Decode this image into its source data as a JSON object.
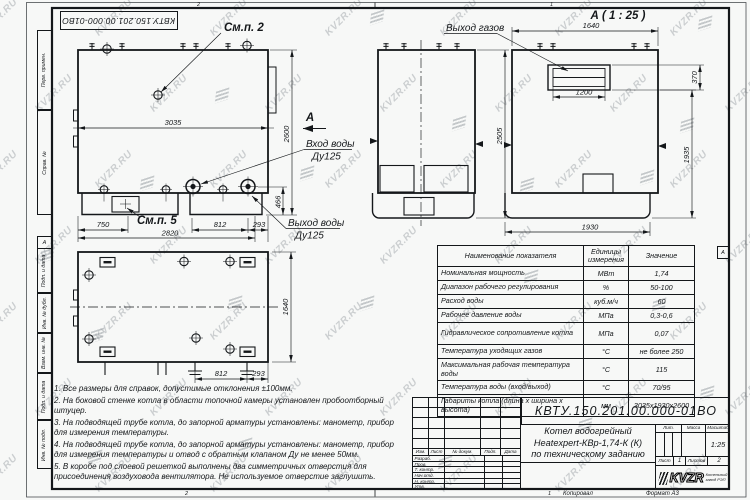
{
  "watermark": {
    "text": "KVZR.RU"
  },
  "sheet": {
    "doc_number": "КВТУ.150.201.00.000-01ВО",
    "zones": {
      "top_left": "2",
      "top_right": "1",
      "bottom_left": "2",
      "bottom_right": "1",
      "side_left": "А",
      "side_right": "А"
    },
    "footer": {
      "copied_by": "Копировал",
      "format": "Формат А3"
    },
    "margin_labels": [
      "Перв. примен.",
      "Справ. №",
      "Подп. и дата",
      "Инв. № дубл.",
      "Взам. инв. №",
      "Подп. и дата",
      "Инв. № подл."
    ]
  },
  "drawing": {
    "front_view": {
      "callout_top": "См.п. 2",
      "callout_base": "См.п. 5",
      "section_arrow": "А",
      "water_inlet_line1": "Вход воды",
      "water_inlet_line2": "Ду125",
      "water_outlet_line1": "Выход воды",
      "water_outlet_line2": "Ду125",
      "dim_width": "3035",
      "dim_height": "2600",
      "dim_750": "750",
      "dim_2820": "2820",
      "dim_812": "812",
      "dim_293": "293",
      "dim_466": "466"
    },
    "side_view": {
      "dim_height": "2505"
    },
    "a_view": {
      "title": "А ( 1 : 25 )",
      "gas_outlet_label": "Выход газов",
      "dim_width": "1640",
      "dim_outlet_width": "1200",
      "dim_outlet_height": "370",
      "dim_height": "1935",
      "dim_base_width": "1930"
    },
    "top_view": {
      "dim_length": "1640",
      "dim_812": "812",
      "dim_293": "293"
    }
  },
  "notes": [
    "1. Все размеры для справок, допустимые отклонения ±100мм.",
    "2. На боковой стенке котла в области топочной камеры установлен пробоотборный штуцер.",
    "3. На подводящей трубе котла, до запорной арматуры установлены: манометр, прибор для измерения температуры.",
    "4. На подводящей трубе котла, до запорной арматуры установлены: манометр, прибор для измерения температуры и отвод с обратным клапаном Ду не менее 50мм.",
    "5. В коробе под слоевой решеткой выполнены два симметричных отверстия для присоединения воздуховода вентилятора. Не используемое отверстие заглушить."
  ],
  "spec_table": {
    "col_name": "Наименование показателя",
    "col_units": "Единицы измерения",
    "col_value": "Значение",
    "rows": [
      {
        "name": "Номинальная мощность",
        "unit": "МВт",
        "value": "1,74",
        "tall": false
      },
      {
        "name": "Диапазон рабочего регулирования",
        "unit": "%",
        "value": "50-100",
        "tall": false
      },
      {
        "name": "Расход воды",
        "unit": "куб.м/ч",
        "value": "60",
        "tall": false
      },
      {
        "name": "Рабочее давление воды",
        "unit": "МПа",
        "value": "0,3-0,6",
        "tall": false
      },
      {
        "name": "Гидравлическое сопротивление котла",
        "unit": "МПа",
        "value": "0,07",
        "tall": true
      },
      {
        "name": "Температура уходящих газов",
        "unit": "°С",
        "value": "не более 250",
        "tall": false
      },
      {
        "name": "Максимальная рабочая температура воды",
        "unit": "°С",
        "value": "115",
        "tall": true
      },
      {
        "name": "Температура воды (вход/выход)",
        "unit": "°С",
        "value": "70/95",
        "tall": false
      },
      {
        "name": "Габариты котла (длина х ширина х высота)",
        "unit": "мм",
        "value": "3035х1930х2600",
        "tall": true
      }
    ]
  },
  "title_block": {
    "doc_number": "КВТУ.150.201.00.000-01ВО",
    "product_line1": "Котел водогрейный",
    "product_line2": "Heatexpert-КВр-1,74-К (К)",
    "product_line3": "по техническому заданию",
    "rev_cols": [
      "Изм.",
      "Лист",
      "№ докум.",
      "Подп.",
      "Дата"
    ],
    "sign_rows": [
      "Разраб.",
      "Пров.",
      "Т. контр.",
      "Нач.отд.",
      "Н. контр.",
      "Утв."
    ],
    "lit_label": "Лит.",
    "mass_label": "Масса",
    "scale_label": "Масштаб",
    "scale_value": "1:25",
    "sheet_label": "Лист",
    "sheet_value": "1",
    "sheets_label": "Листов",
    "sheets_value": "2",
    "logo_text": "KVZR",
    "logo_caption_line1": "Котельный",
    "logo_caption_line2": "завод РЭП"
  }
}
